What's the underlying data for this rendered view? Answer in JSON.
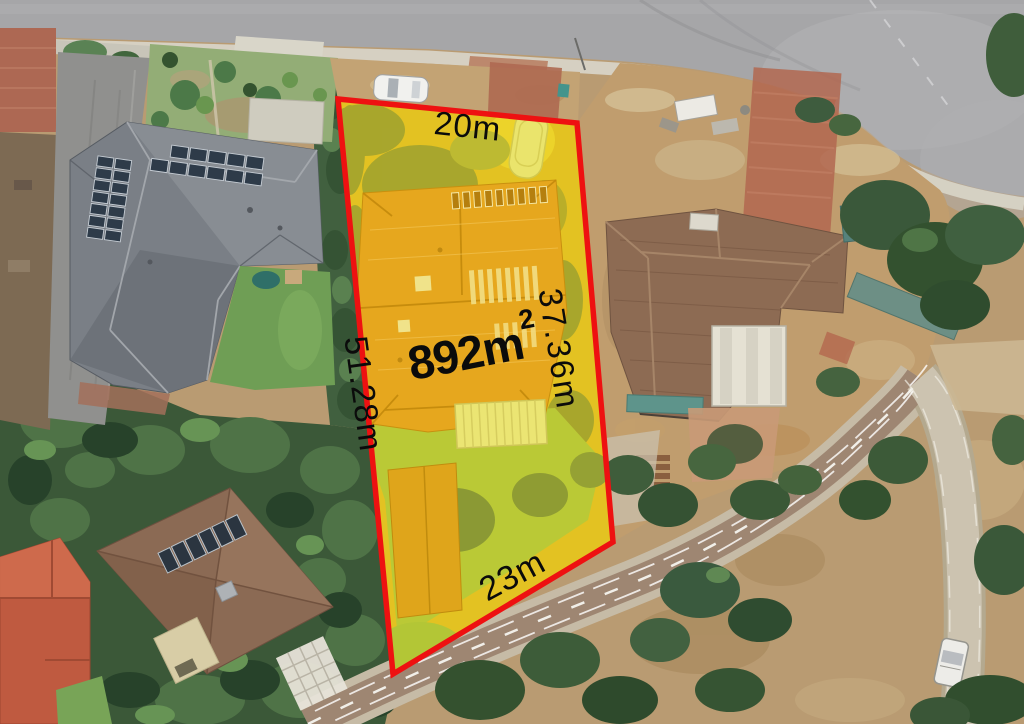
{
  "parcel": {
    "area": {
      "value": "892m",
      "superscript": "2"
    },
    "dimensions": {
      "top": "20m",
      "right": "37.36m",
      "left": "51.28m",
      "bottom": "23m"
    },
    "boundary_color": "#ee1111",
    "highlight_color": "#e3c222"
  }
}
